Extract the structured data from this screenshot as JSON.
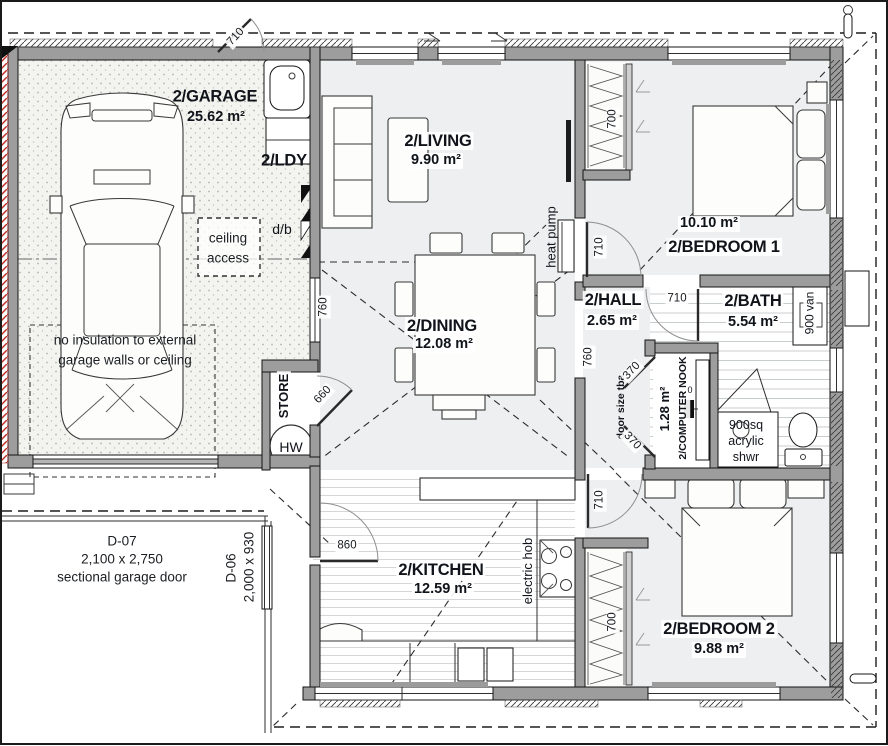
{
  "colors": {
    "wall": "#9d9d9d",
    "line": "#1c1c1c",
    "floor": "#edeff0",
    "garage_floor": "#f3f3ef",
    "tile_line": "#c8cdd0",
    "red_hatch": "#c03028"
  },
  "rooms": {
    "garage": {
      "name": "2/GARAGE",
      "area": "25.62 m²"
    },
    "laundry": {
      "name": "2/LDY"
    },
    "living": {
      "name": "2/LIVING",
      "area": "9.90 m²"
    },
    "bedroom1": {
      "name": "2/BEDROOM 1",
      "area": "10.10 m²"
    },
    "hall": {
      "name": "2/HALL",
      "area": "2.65 m²"
    },
    "bath": {
      "name": "2/BATH",
      "area": "5.54 m²"
    },
    "dining": {
      "name": "2/DINING",
      "area": "12.08 m²"
    },
    "kitchen": {
      "name": "2/KITCHEN",
      "area": "12.59 m²"
    },
    "bedroom2": {
      "name": "2/BEDROOM 2",
      "area": "9.88 m²"
    },
    "computer_nook": {
      "name": "2/COMPUTER NOOK",
      "area": "1.28 m²"
    },
    "store": {
      "name": "STORE"
    }
  },
  "fixtures": {
    "hot_water": "HW",
    "heat_pump": "heat pump",
    "electric_hob": "electric hob",
    "shower_line1": "900sq",
    "shower_line2": "acrylic",
    "shower_line3": "shwr",
    "vanity": "900 van",
    "distribution_board": "d/b",
    "outlet": "0"
  },
  "notes": {
    "ceiling_access_line1": "ceiling",
    "ceiling_access_line2": "access",
    "no_insulation_line1": "no insulation to external",
    "no_insulation_line2": "garage walls or ceiling",
    "door_size": "door size tba"
  },
  "doors": {
    "d07_code": "D-07",
    "d07_size": "2,100 x 2,750",
    "d07_type": "sectional garage door",
    "d06_code": "D-06",
    "d06_size": "2,000 x 930"
  },
  "dimensions": {
    "garage_entry_door": "710",
    "bed1_wardrobe": "700",
    "bed1_door": "710",
    "bath_door": "710",
    "servery_window": "760",
    "hall_opening": "760",
    "store_door": "660",
    "nook_door_upper": "370",
    "nook_door_lower": "370",
    "bed2_door": "710",
    "bed2_wardrobe": "700",
    "kitchen_door": "860"
  }
}
